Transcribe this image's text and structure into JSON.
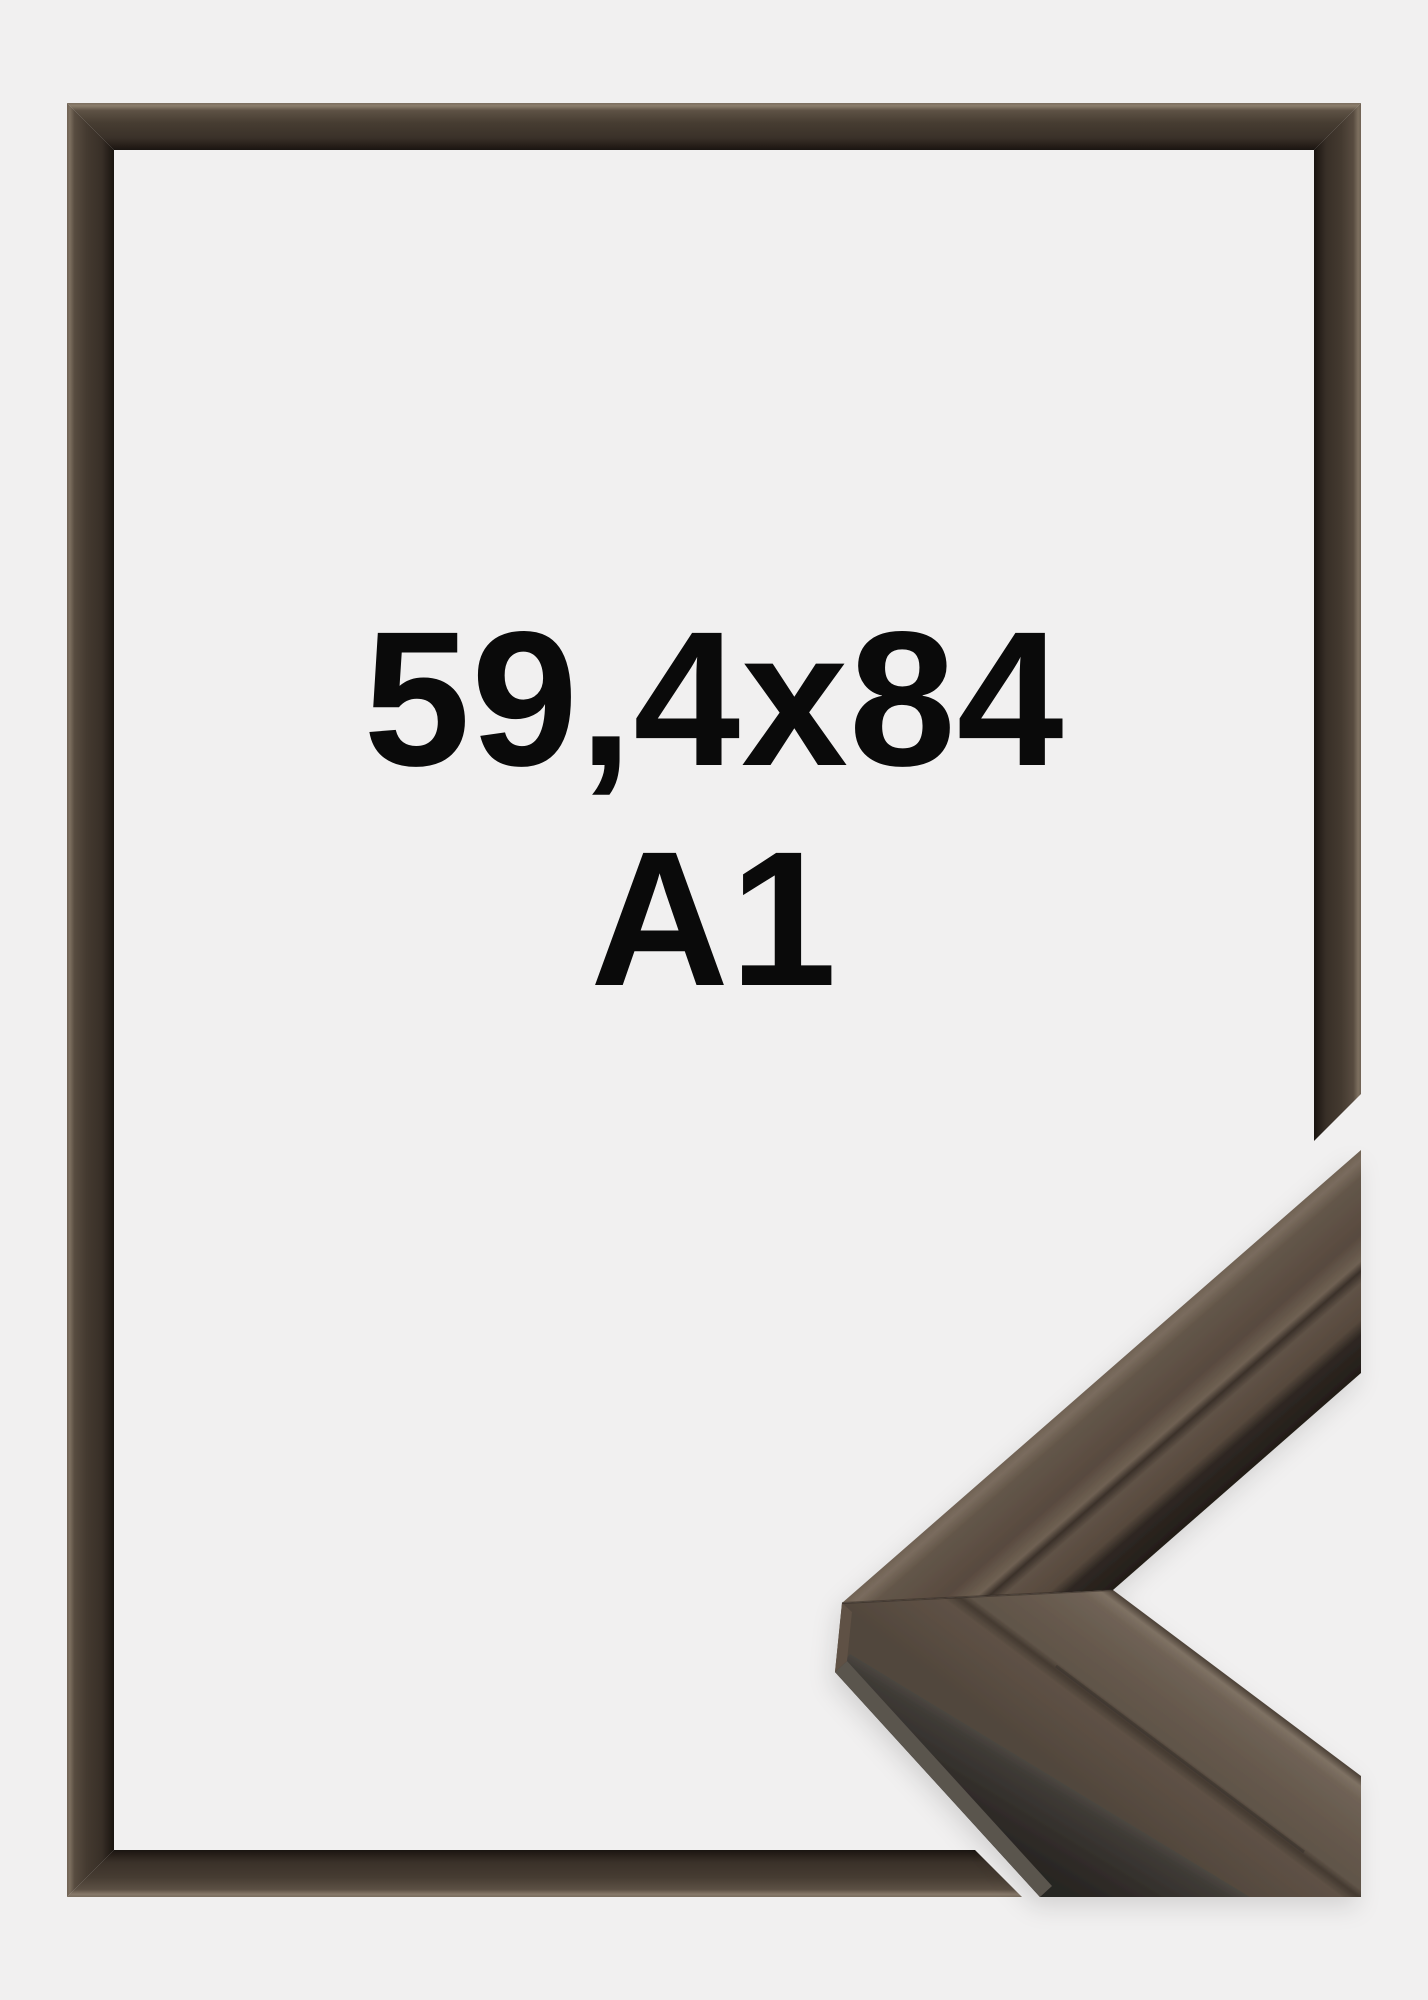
{
  "page": {
    "background_color": "#f1f0f0",
    "text_color": "#0a0a0a"
  },
  "product": {
    "size_label": "59,4x84",
    "format_label": "A1"
  },
  "frame": {
    "description": "dark brown glossy picture frame preview",
    "outer_highlight_color": "#8b7d6c",
    "face_color": "#473d32",
    "inner_shadow_color": "#1a1511"
  },
  "corner_sample": {
    "description": "frame moulding corner profile close-up",
    "top_face_color": "#5f5246",
    "highlight_color": "#7f7264",
    "side_face_color": "#312d2a",
    "base_edge_color": "#5a544e"
  }
}
